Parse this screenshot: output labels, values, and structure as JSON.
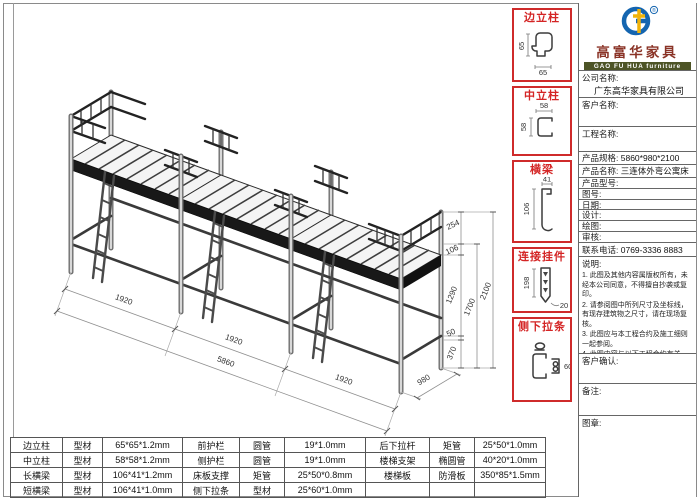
{
  "drawing": {
    "dims": {
      "seg1": "1920",
      "seg2": "1920",
      "seg3": "1920",
      "total": "5860",
      "depth": "980",
      "guard": "254",
      "beam": "106",
      "clear": "1290",
      "gap": "50",
      "bottom": "370",
      "bed_height": "1700",
      "total_height": "2100"
    }
  },
  "profiles": [
    {
      "title": "边立柱",
      "dim_a": "65",
      "dim_b": "65"
    },
    {
      "title": "中立柱",
      "dim_a": "58",
      "dim_b": "58"
    },
    {
      "title": "横梁",
      "dim_a": "41",
      "dim_b": "106"
    },
    {
      "title": "连接挂件",
      "dim_a": "198",
      "dim_b": "20"
    },
    {
      "title": "侧下拉条",
      "dim_a": "60",
      "dim_b": ""
    }
  ],
  "title_block": {
    "brand": {
      "name_cn": "高富华家具",
      "name_en": "GAO FU HUA furniture",
      "reg": "®"
    },
    "rows": [
      {
        "label": "公司名称:",
        "value": "广东高华家具有限公司"
      },
      {
        "label": "客户名称:",
        "value": ""
      },
      {
        "label": "工程名称:",
        "value": ""
      },
      {
        "label": "产品规格:",
        "value": "5860*980*2100"
      },
      {
        "label": "产品名称:",
        "value": "三连体外弯公寓床"
      },
      {
        "label": "产品型号:",
        "value": ""
      },
      {
        "label": "图号:",
        "value": ""
      },
      {
        "label": "日期:",
        "value": ""
      },
      {
        "label": "设计:",
        "value": ""
      },
      {
        "label": "绘图:",
        "value": ""
      },
      {
        "label": "审核:",
        "value": ""
      },
      {
        "label": "联系电话:",
        "value": "0769-3336 8883"
      }
    ],
    "notes": {
      "title": "说明:",
      "items": [
        "1. 此图及其他内容属版权所有，未经本公司同意，不得擅自抄袭或复印。",
        "2. 请参阅图中所列尺寸及坐标线，有现存建筑物之尺寸，请在现场复核。",
        "3. 此图应与本工程合约及施工细则一起参阅。",
        "4. 此图内容与以下工程合约有关。"
      ]
    },
    "confirm_label": "客户确认:",
    "remark_label": "备注:",
    "seal_label": "图章:"
  },
  "parts_table": {
    "rows": [
      [
        "边立柱",
        "型材",
        "65*65*1.2mm",
        "前护栏",
        "圆管",
        "19*1.0mm",
        "后下拉杆",
        "矩管",
        "25*50*1.0mm"
      ],
      [
        "中立柱",
        "型材",
        "58*58*1.2mm",
        "侧护栏",
        "圆管",
        "19*1.0mm",
        "楼梯支架",
        "椭圆管",
        "40*20*1.0mm"
      ],
      [
        "长横梁",
        "型材",
        "106*41*1.2mm",
        "床板支撑",
        "矩管",
        "25*50*0.8mm",
        "楼梯板",
        "防滑板",
        "350*85*1.5mm"
      ],
      [
        "短横梁",
        "型材",
        "106*41*1.0mm",
        "侧下拉条",
        "型材",
        "25*60*1.0mm",
        "",
        "",
        ""
      ]
    ]
  }
}
